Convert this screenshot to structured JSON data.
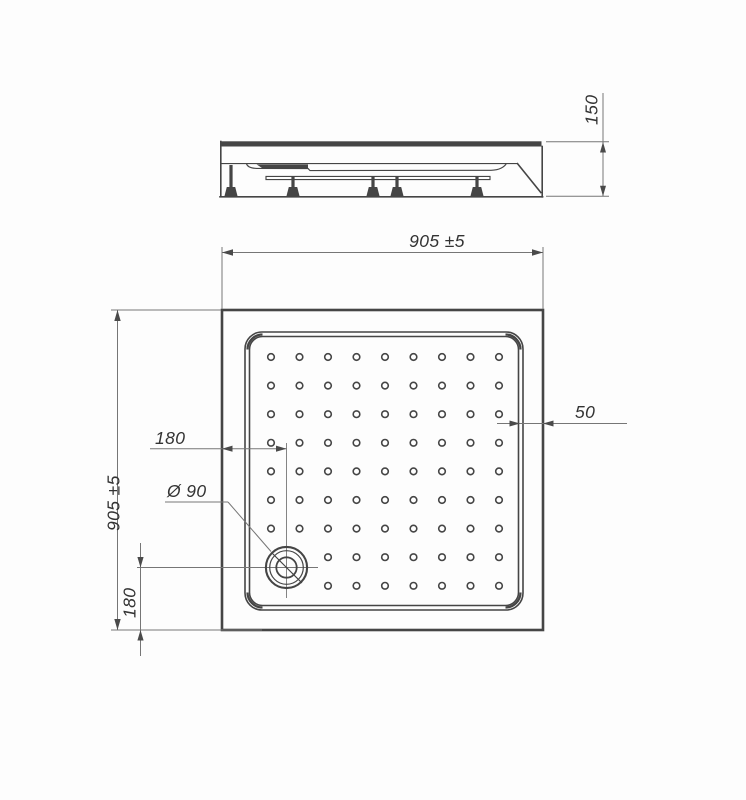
{
  "document": {
    "type": "technical drawing",
    "subject": "square shower tray, side elevation and plan view"
  },
  "dimensions": {
    "height": "150",
    "overall_width_top": "905 ±5",
    "overall_depth_left": "905 ±5",
    "rim_width": "50",
    "drain_offset_x": "180",
    "drain_offset_y": "180",
    "drain_diameter": "Ø 90"
  },
  "colors": {
    "line": "#454545",
    "dim_line": "#767676",
    "arrow": "#4a4a4a",
    "text": "#333333",
    "background": "#fdfdfd"
  },
  "plan": {
    "dots": {
      "cols": 9,
      "rows": 9,
      "x0": 271,
      "y0": 357,
      "dx": 28.5,
      "dy": 28.6,
      "r": 3.3,
      "skip": [
        [
          0,
          7
        ],
        [
          1,
          7
        ],
        [
          0,
          8
        ],
        [
          1,
          8
        ]
      ]
    },
    "drain": {
      "cx": 286.5,
      "cy": 567.5,
      "r_outer": 20.6,
      "r_mid": 16.8,
      "r_inner": 10.2
    }
  },
  "side": {
    "legs": [
      {
        "x": 231,
        "stem_top": 165
      },
      {
        "x": 293,
        "stem_top": 176
      },
      {
        "x": 373,
        "stem_top": 176
      },
      {
        "x": 397,
        "stem_top": 176
      },
      {
        "x": 477,
        "stem_top": 176
      }
    ]
  }
}
